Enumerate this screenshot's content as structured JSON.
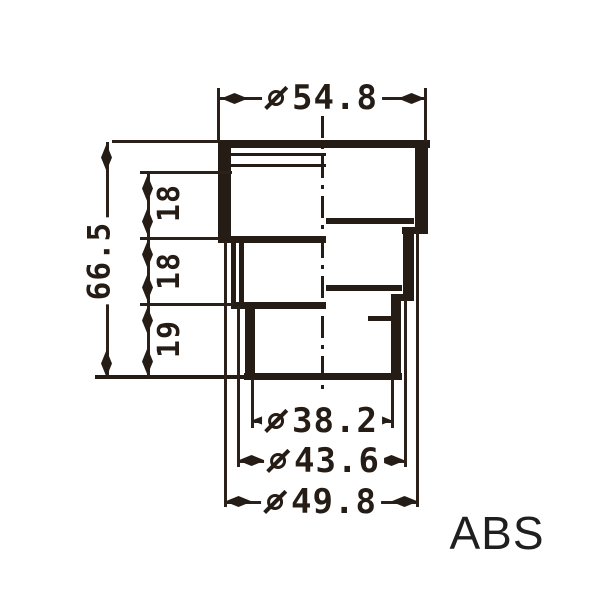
{
  "drawing": {
    "material_label": "ABS",
    "line_color": "#261c16",
    "top_dim": {
      "symbol": "diameter",
      "value": "54.8"
    },
    "height_dim": {
      "value": "66.5"
    },
    "step_dims": [
      {
        "value": "18"
      },
      {
        "value": "18"
      },
      {
        "value": "19"
      }
    ],
    "bottom_dims": [
      {
        "symbol": "diameter",
        "value": "38.2"
      },
      {
        "symbol": "diameter",
        "value": "43.6"
      },
      {
        "symbol": "diameter",
        "value": "49.8"
      }
    ]
  }
}
